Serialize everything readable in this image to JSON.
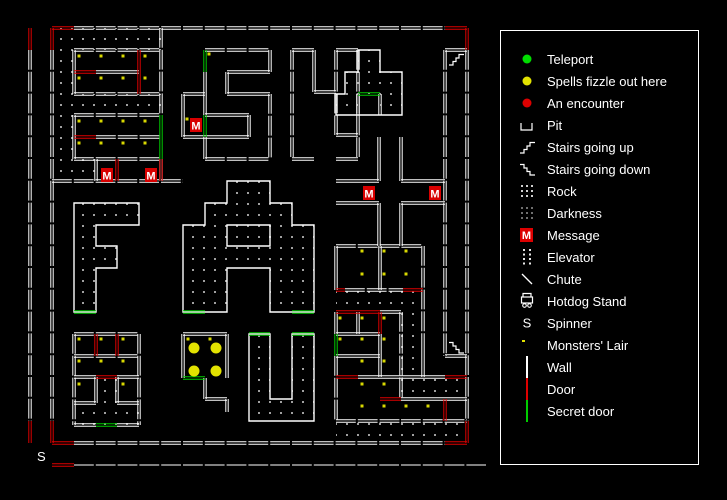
{
  "legend": {
    "items": [
      {
        "id": "teleport",
        "label": "Teleport",
        "icon": "dot",
        "color": "#00dd00"
      },
      {
        "id": "fizzle",
        "label": "Spells fizzle out here",
        "icon": "dot",
        "color": "#e2e200"
      },
      {
        "id": "encounter",
        "label": "An encounter",
        "icon": "dot",
        "color": "#dd0000"
      },
      {
        "id": "pit",
        "label": "Pit",
        "icon": "pit",
        "color": "#ffffff"
      },
      {
        "id": "stairs-up",
        "label": "Stairs going up",
        "icon": "stairs-up",
        "color": "#ffffff"
      },
      {
        "id": "stairs-down",
        "label": "Stairs going down",
        "icon": "stairs-down",
        "color": "#ffffff"
      },
      {
        "id": "rock",
        "label": "Rock",
        "icon": "dots9",
        "color": "#cfcfcf"
      },
      {
        "id": "darkness",
        "label": "Darkness",
        "icon": "dots9",
        "color": "#6f6f6f"
      },
      {
        "id": "message",
        "label": "Message",
        "icon": "message",
        "color": "#dd0000"
      },
      {
        "id": "elevator",
        "label": "Elevator",
        "icon": "dots8",
        "color": "#e8e8e8"
      },
      {
        "id": "chute",
        "label": "Chute",
        "icon": "chute",
        "color": "#ffffff"
      },
      {
        "id": "hotdog",
        "label": "Hotdog Stand",
        "icon": "hotdog",
        "color": "#ffffff"
      },
      {
        "id": "spinner",
        "label": "Spinner",
        "icon": "letter-s",
        "color": "#ffffff"
      },
      {
        "id": "lair",
        "label": "Monsters' Lair",
        "icon": "lair",
        "color": "#e2e200"
      },
      {
        "id": "wall",
        "label": "Wall",
        "icon": "vline",
        "color": "#ffffff"
      },
      {
        "id": "door",
        "label": "Door",
        "icon": "vline",
        "color": "#dd0000"
      },
      {
        "id": "secret",
        "label": "Secret door",
        "icon": "vline",
        "color": "#00cc00"
      }
    ]
  },
  "map": {
    "message_char": "M",
    "spinner_char": "S",
    "spinner_pos": {
      "x": 37,
      "y": 461
    },
    "colors": {
      "wall": "#ffffff",
      "door": "#dd0000",
      "secret": "#00cc00",
      "rock_dot": "#a0a0a0",
      "lair": "#d8d800",
      "fizzle": "#e2e200",
      "message_bg": "#d80000"
    },
    "walls": [
      [
        74,
        28,
        445,
        28
      ],
      [
        30,
        50,
        30,
        421
      ],
      [
        467,
        50,
        467,
        421
      ],
      [
        74,
        443,
        445,
        443
      ],
      [
        52,
        50,
        52,
        421
      ],
      [
        74,
        465,
        486,
        465,
        "single"
      ],
      [
        161,
        28,
        161,
        115
      ],
      [
        161,
        159,
        161,
        181
      ],
      [
        52,
        181,
        183,
        181
      ],
      [
        74,
        50,
        161,
        50
      ],
      [
        74,
        94,
        161,
        94
      ],
      [
        74,
        50,
        74,
        94
      ],
      [
        96,
        72,
        139,
        72
      ],
      [
        74,
        115,
        161,
        115
      ],
      [
        74,
        159,
        161,
        159
      ],
      [
        74,
        115,
        74,
        159
      ],
      [
        96,
        137,
        161,
        137
      ],
      [
        96,
        159,
        96,
        181
      ],
      [
        205,
        50,
        270,
        50
      ],
      [
        270,
        50,
        270,
        72
      ],
      [
        227,
        72,
        270,
        72
      ],
      [
        227,
        72,
        227,
        94
      ],
      [
        227,
        94,
        270,
        94
      ],
      [
        270,
        94,
        270,
        159
      ],
      [
        205,
        159,
        270,
        159
      ],
      [
        205,
        137,
        205,
        159
      ],
      [
        205,
        137,
        249,
        137
      ],
      [
        249,
        115,
        249,
        137
      ],
      [
        205,
        115,
        249,
        115
      ],
      [
        205,
        72,
        205,
        115
      ],
      [
        183,
        94,
        183,
        137
      ],
      [
        183,
        94,
        205,
        94
      ],
      [
        183,
        137,
        205,
        137
      ],
      [
        292,
        50,
        314,
        50
      ],
      [
        292,
        50,
        292,
        159
      ],
      [
        292,
        159,
        314,
        159
      ],
      [
        314,
        50,
        314,
        92
      ],
      [
        314,
        92,
        336,
        92
      ],
      [
        336,
        50,
        336,
        135
      ],
      [
        336,
        135,
        358,
        135
      ],
      [
        336,
        50,
        358,
        50
      ],
      [
        358,
        50,
        358,
        159
      ],
      [
        336,
        159,
        358,
        159
      ],
      [
        358,
        94,
        358,
        115
      ],
      [
        380,
        94,
        380,
        115
      ],
      [
        336,
        181,
        379,
        181
      ],
      [
        401,
        181,
        445,
        181
      ],
      [
        336,
        203,
        379,
        203
      ],
      [
        401,
        203,
        445,
        203
      ],
      [
        379,
        137,
        379,
        181
      ],
      [
        401,
        137,
        401,
        181
      ],
      [
        379,
        203,
        379,
        246
      ],
      [
        401,
        203,
        401,
        246
      ],
      [
        336,
        246,
        423,
        246
      ],
      [
        336,
        246,
        336,
        290
      ],
      [
        380,
        246,
        380,
        290
      ],
      [
        423,
        246,
        423,
        334
      ],
      [
        345,
        290,
        403,
        290
      ],
      [
        380,
        312,
        401,
        312
      ],
      [
        336,
        312,
        336,
        334
      ],
      [
        336,
        356,
        336,
        421
      ],
      [
        358,
        312,
        358,
        334
      ],
      [
        336,
        334,
        380,
        334
      ],
      [
        336,
        356,
        380,
        356
      ],
      [
        380,
        334,
        380,
        377
      ],
      [
        358,
        377,
        401,
        377
      ],
      [
        401,
        312,
        401,
        399
      ],
      [
        423,
        334,
        423,
        377
      ],
      [
        401,
        377,
        445,
        377
      ],
      [
        445,
        399,
        467,
        399
      ],
      [
        401,
        399,
        445,
        399
      ],
      [
        401,
        421,
        467,
        421
      ],
      [
        336,
        421,
        401,
        421
      ],
      [
        445,
        50,
        445,
        356
      ],
      [
        445,
        356,
        467,
        356
      ],
      [
        445,
        50,
        467,
        50
      ],
      [
        183,
        334,
        227,
        334
      ],
      [
        183,
        334,
        183,
        378
      ],
      [
        205,
        378,
        205,
        399
      ],
      [
        205,
        399,
        227,
        399
      ],
      [
        227,
        334,
        227,
        378
      ],
      [
        227,
        399,
        227,
        412
      ],
      [
        74,
        334,
        74,
        425
      ],
      [
        139,
        334,
        139,
        425
      ],
      [
        74,
        334,
        139,
        334
      ],
      [
        74,
        425,
        96,
        425
      ],
      [
        117,
        425,
        139,
        425
      ],
      [
        74,
        356,
        139,
        356
      ],
      [
        74,
        377,
        96,
        377
      ],
      [
        117,
        377,
        139,
        377
      ],
      [
        96,
        377,
        96,
        403
      ],
      [
        117,
        377,
        117,
        403
      ],
      [
        74,
        403,
        96,
        403
      ],
      [
        117,
        403,
        139,
        403
      ]
    ],
    "doors": [
      [
        52,
        28,
        74,
        28
      ],
      [
        445,
        28,
        467,
        28
      ],
      [
        30,
        28,
        30,
        50
      ],
      [
        52,
        28,
        52,
        50
      ],
      [
        467,
        28,
        467,
        50
      ],
      [
        30,
        421,
        30,
        443
      ],
      [
        52,
        421,
        52,
        443
      ],
      [
        52,
        443,
        74,
        443
      ],
      [
        445,
        443,
        467,
        443
      ],
      [
        467,
        421,
        467,
        443
      ],
      [
        52,
        465,
        74,
        465
      ],
      [
        74,
        72,
        96,
        72
      ],
      [
        139,
        50,
        139,
        94
      ],
      [
        74,
        137,
        96,
        137
      ],
      [
        117,
        159,
        117,
        181
      ],
      [
        161,
        159,
        161,
        181
      ],
      [
        336,
        290,
        345,
        290
      ],
      [
        403,
        290,
        423,
        290
      ],
      [
        336,
        312,
        380,
        312
      ],
      [
        380,
        312,
        380,
        334
      ],
      [
        336,
        377,
        358,
        377
      ],
      [
        380,
        399,
        401,
        399
      ],
      [
        445,
        399,
        445,
        421
      ],
      [
        445,
        377,
        467,
        377
      ],
      [
        96,
        334,
        96,
        356
      ],
      [
        117,
        334,
        117,
        356
      ],
      [
        96,
        377,
        117,
        377
      ]
    ],
    "secrets": [
      [
        161,
        115,
        161,
        159
      ],
      [
        205,
        50,
        205,
        72
      ],
      [
        205,
        115,
        205,
        137
      ],
      [
        358,
        94,
        380,
        94
      ],
      [
        74,
        312,
        96,
        312
      ],
      [
        183,
        312,
        205,
        312
      ],
      [
        292,
        312,
        314,
        312
      ],
      [
        336,
        334,
        336,
        356
      ],
      [
        183,
        378,
        205,
        378
      ],
      [
        96,
        425,
        117,
        425
      ],
      [
        249,
        334,
        270,
        334
      ],
      [
        292,
        334,
        314,
        334
      ]
    ],
    "polys": [
      [
        358,
        50,
        380,
        50,
        380,
        72,
        402,
        72,
        402,
        115,
        336,
        115,
        336,
        94,
        345,
        94,
        345,
        72,
        358,
        72
      ],
      [
        74,
        203,
        139,
        203,
        139,
        225,
        96,
        225,
        96,
        246,
        117,
        246,
        117,
        268,
        96,
        268,
        96,
        312,
        74,
        312
      ],
      [
        227,
        181,
        270,
        181,
        270,
        203,
        292,
        203,
        292,
        225,
        314,
        225,
        314,
        312,
        270,
        312,
        270,
        268,
        227,
        268,
        227,
        312,
        183,
        312,
        183,
        225,
        205,
        225,
        205,
        203,
        227,
        203
      ],
      [
        227,
        225,
        270,
        225,
        270,
        246,
        227,
        246
      ],
      [
        249,
        334,
        270,
        334,
        270,
        399,
        292,
        399,
        292,
        334,
        314,
        334,
        314,
        421,
        249,
        421
      ]
    ],
    "rocks": [
      [
        52,
        28,
        161,
        50
      ],
      [
        52,
        50,
        74,
        181
      ],
      [
        74,
        94,
        161,
        115
      ],
      [
        74,
        159,
        96,
        181
      ],
      [
        358,
        50,
        380,
        72
      ],
      [
        345,
        72,
        402,
        94
      ],
      [
        336,
        94,
        358,
        115
      ],
      [
        380,
        94,
        402,
        115
      ],
      [
        74,
        203,
        139,
        225
      ],
      [
        74,
        225,
        96,
        312
      ],
      [
        96,
        246,
        117,
        268
      ],
      [
        227,
        181,
        270,
        203
      ],
      [
        205,
        203,
        292,
        225
      ],
      [
        183,
        225,
        314,
        268
      ],
      [
        183,
        268,
        227,
        312
      ],
      [
        270,
        268,
        314,
        312
      ],
      [
        336,
        290,
        423,
        312
      ],
      [
        401,
        312,
        423,
        399
      ],
      [
        423,
        377,
        467,
        399
      ],
      [
        336,
        421,
        467,
        443
      ],
      [
        249,
        334,
        270,
        399
      ],
      [
        292,
        334,
        314,
        399
      ],
      [
        249,
        399,
        314,
        421
      ],
      [
        96,
        377,
        117,
        403
      ],
      [
        74,
        403,
        139,
        425
      ]
    ],
    "messages": [
      {
        "x": 101,
        "y": 168
      },
      {
        "x": 145,
        "y": 168
      },
      {
        "x": 190,
        "y": 118
      },
      {
        "x": 363,
        "y": 186
      },
      {
        "x": 429,
        "y": 186
      }
    ],
    "monster_dots": [
      [
        79,
        56
      ],
      [
        101,
        56
      ],
      [
        123,
        56
      ],
      [
        145,
        56
      ],
      [
        79,
        78
      ],
      [
        101,
        78
      ],
      [
        123,
        78
      ],
      [
        145,
        78
      ],
      [
        79,
        121
      ],
      [
        101,
        121
      ],
      [
        123,
        121
      ],
      [
        145,
        121
      ],
      [
        79,
        143
      ],
      [
        101,
        143
      ],
      [
        123,
        143
      ],
      [
        145,
        143
      ],
      [
        209,
        54
      ],
      [
        187,
        119
      ],
      [
        362,
        251
      ],
      [
        384,
        251
      ],
      [
        406,
        251
      ],
      [
        362,
        274
      ],
      [
        384,
        274
      ],
      [
        406,
        274
      ],
      [
        340,
        318
      ],
      [
        362,
        318
      ],
      [
        384,
        318
      ],
      [
        340,
        339
      ],
      [
        362,
        339
      ],
      [
        384,
        339
      ],
      [
        362,
        361
      ],
      [
        384,
        361
      ],
      [
        362,
        384
      ],
      [
        384,
        384
      ],
      [
        362,
        406
      ],
      [
        384,
        406
      ],
      [
        406,
        406
      ],
      [
        428,
        406
      ],
      [
        188,
        339
      ],
      [
        210,
        339
      ],
      [
        79,
        339
      ],
      [
        101,
        339
      ],
      [
        123,
        339
      ],
      [
        79,
        361
      ],
      [
        101,
        361
      ],
      [
        123,
        361
      ],
      [
        79,
        384
      ],
      [
        123,
        384
      ]
    ],
    "fizzle_dots": [
      [
        194,
        348
      ],
      [
        216,
        348
      ],
      [
        194,
        371
      ],
      [
        216,
        371
      ]
    ],
    "stairs": [
      {
        "x": 449,
        "y": 51,
        "dir": "up"
      },
      {
        "x": 449,
        "y": 339,
        "dir": "down"
      }
    ]
  }
}
